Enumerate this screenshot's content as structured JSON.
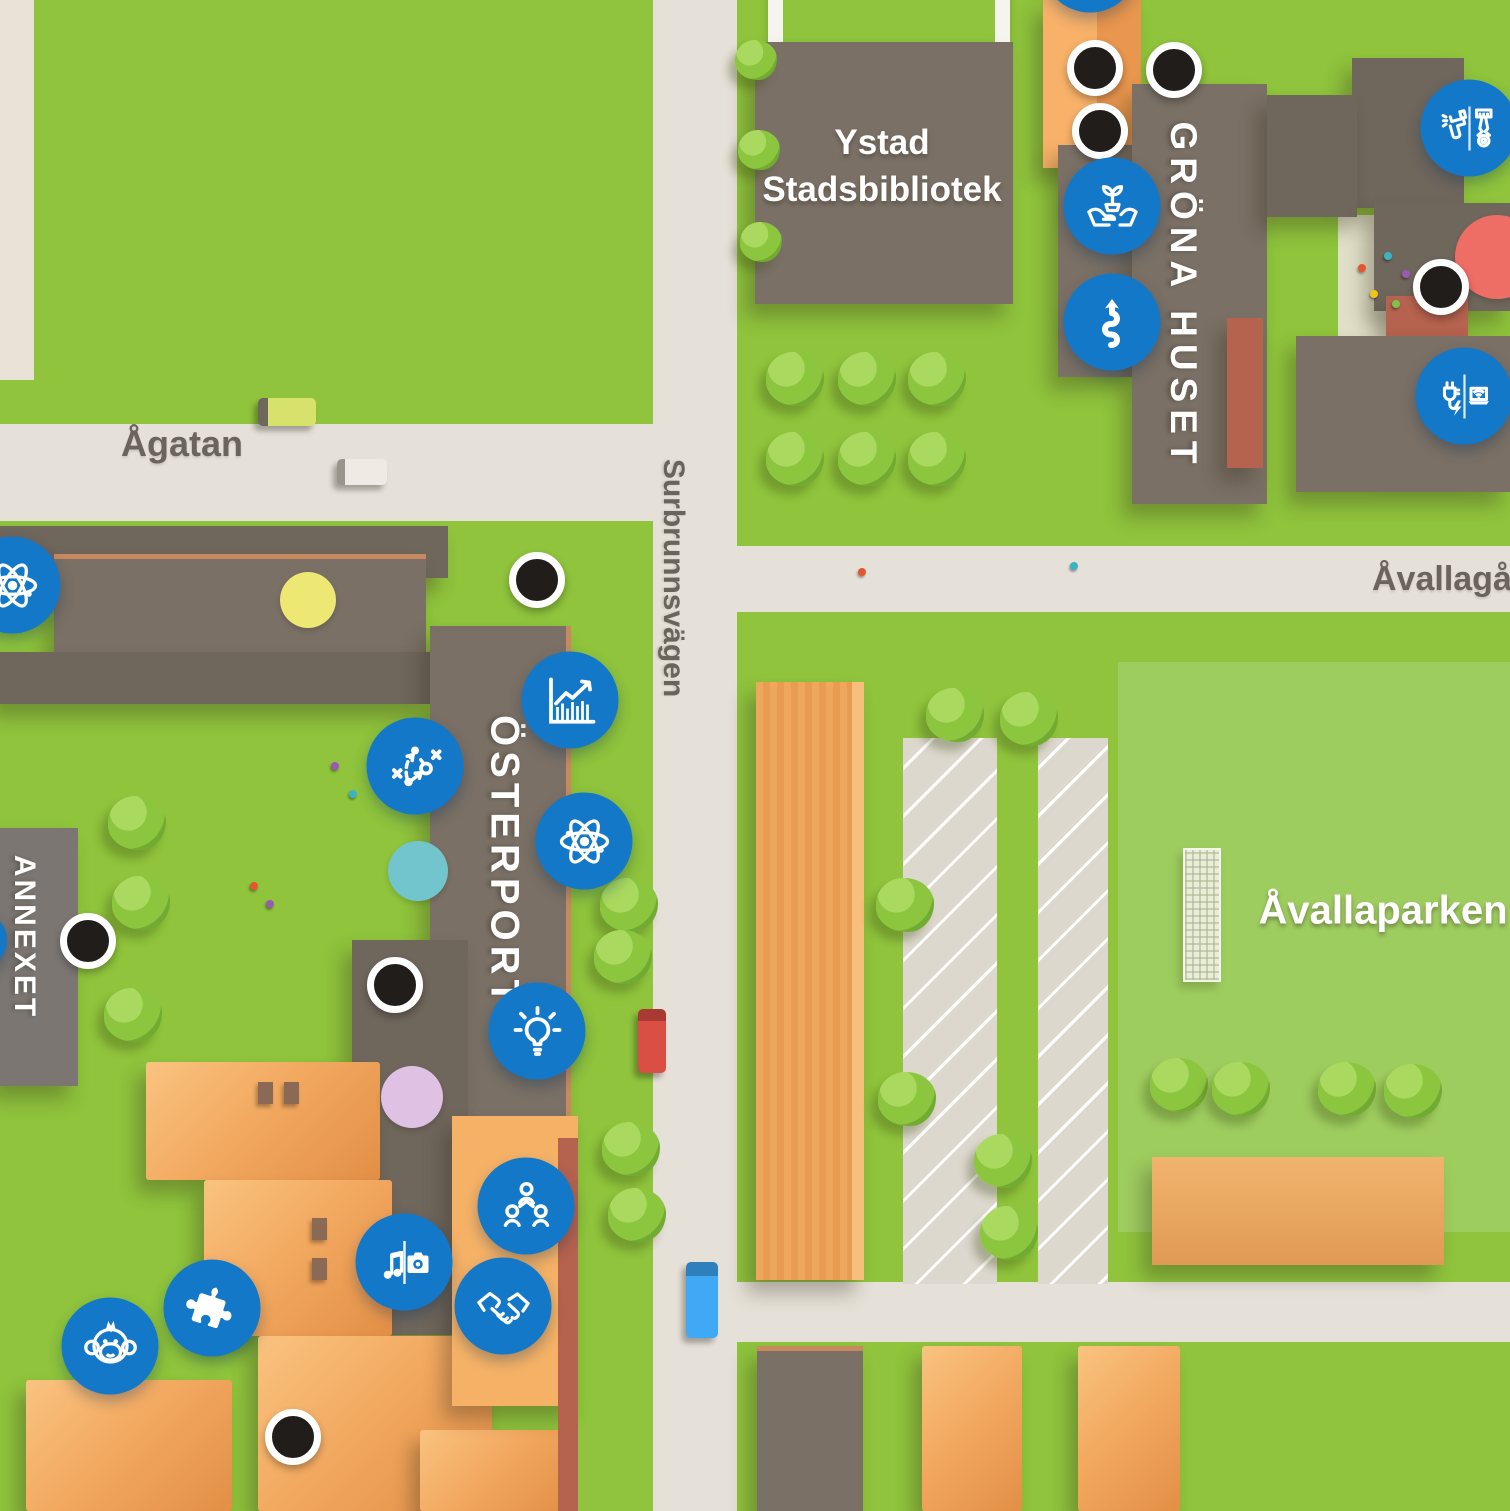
{
  "map_title": "Ystad campus illustrated map",
  "streets": {
    "agatan": "Ågatan",
    "surbrunnsvagen": "Surbrunnsvägen",
    "avallagangen": "Åvallagången"
  },
  "places": {
    "library_line1": "Ystad",
    "library_line2": "Stadsbibliotek",
    "grona_huset": "GRÖNA HUSET",
    "osterport": "ÖSTERPORT",
    "annexet": "ANNEXET",
    "avallaparken": "Åvallaparken"
  },
  "markers": {
    "science_west": "atom-icon",
    "economics": "bar-chart-icon",
    "strategy": "tactics-icon",
    "science_east": "atom-icon",
    "idea": "lightbulb-icon",
    "organisation": "people-group-icon",
    "music_media": "music-camera-icon",
    "cooperation": "handshake-icon",
    "puzzle": "puzzle-icon",
    "monkey": "monkey-icon",
    "sustainability": "plant-hands-icon",
    "route": "winding-arrow-icon",
    "vehicle": "spray-gun-piston-icon",
    "power_it": "plug-laptop-icon",
    "black_dot": "location-dot",
    "yellow_spot": "yellow-spot",
    "teal_spot": "teal-spot",
    "pink_spot": "pink-spot",
    "red_spot": "red-spot"
  },
  "colors": {
    "marker_blue": "#1478C8",
    "grass": "#8FC43C",
    "park_green": "#9ECD5F",
    "road": "#E6E1D8",
    "building_brown": "#7A7065",
    "building_brown_dark": "#6F665C",
    "building_gray": "#7B7672",
    "building_orange": "#F2A85F",
    "brick_rust": "#B5624E",
    "dot_black": "#211D1B",
    "spot_yellow": "#EDE873",
    "spot_teal": "#72C5CC",
    "spot_pink": "#DFC1E3",
    "spot_red": "#EE6E66"
  }
}
